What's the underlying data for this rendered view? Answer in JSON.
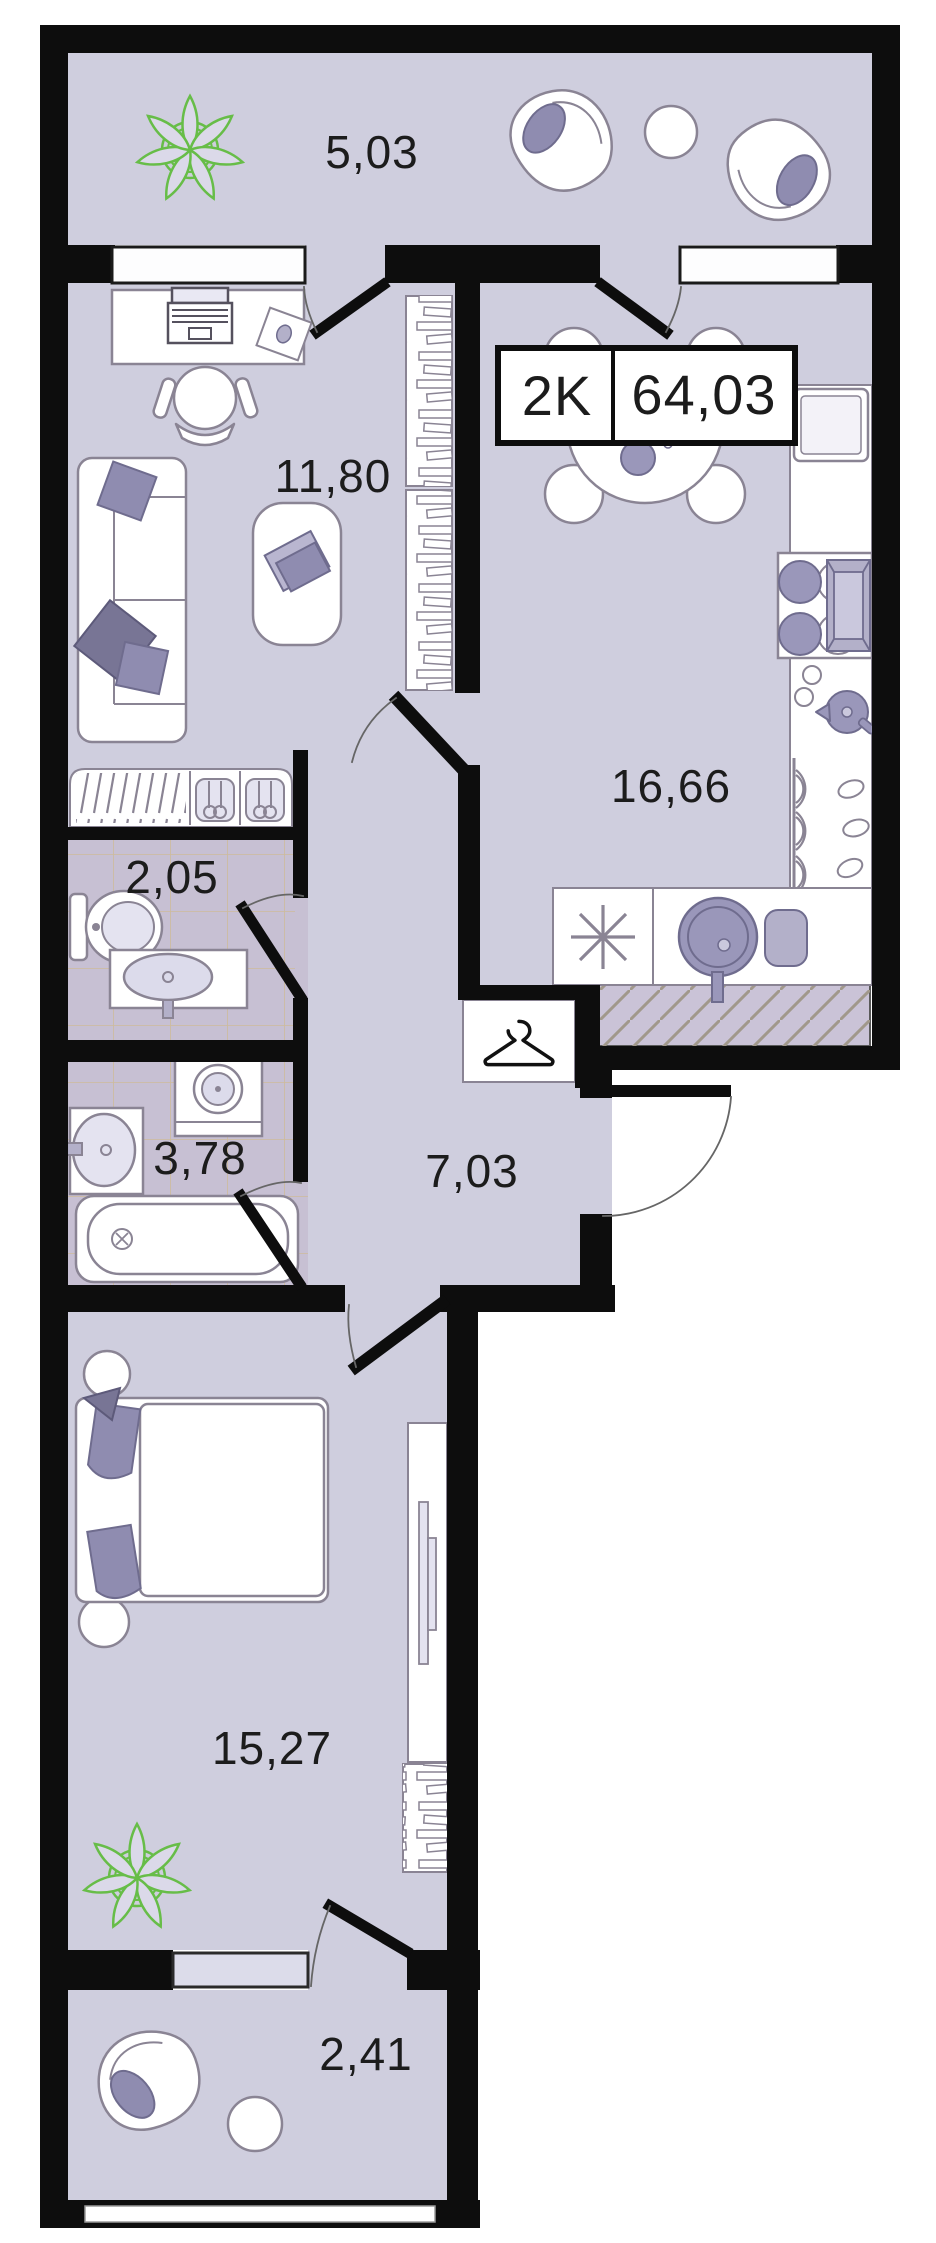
{
  "plan": {
    "unit": {
      "rooms_label": "2K",
      "area_label": "64,03"
    },
    "rooms": [
      {
        "name": "loggia-top",
        "area": "5,03"
      },
      {
        "name": "living-room",
        "area": "11,80"
      },
      {
        "name": "kitchen",
        "area": "16,66"
      },
      {
        "name": "wc",
        "area": "2,05"
      },
      {
        "name": "bathroom",
        "area": "3,78"
      },
      {
        "name": "hallway",
        "area": "7,03"
      },
      {
        "name": "bedroom",
        "area": "15,27"
      },
      {
        "name": "loggia-bottom",
        "area": "2,41"
      }
    ],
    "colors": {
      "wall": "#0d0d0d",
      "floor": "#cfcede",
      "tile": "#c7c0d3",
      "accent": "#8f8cb0",
      "accent_dark": "#6f6c8e",
      "plant_green": "#67bd48",
      "furniture_stroke": "#8a8494"
    }
  }
}
